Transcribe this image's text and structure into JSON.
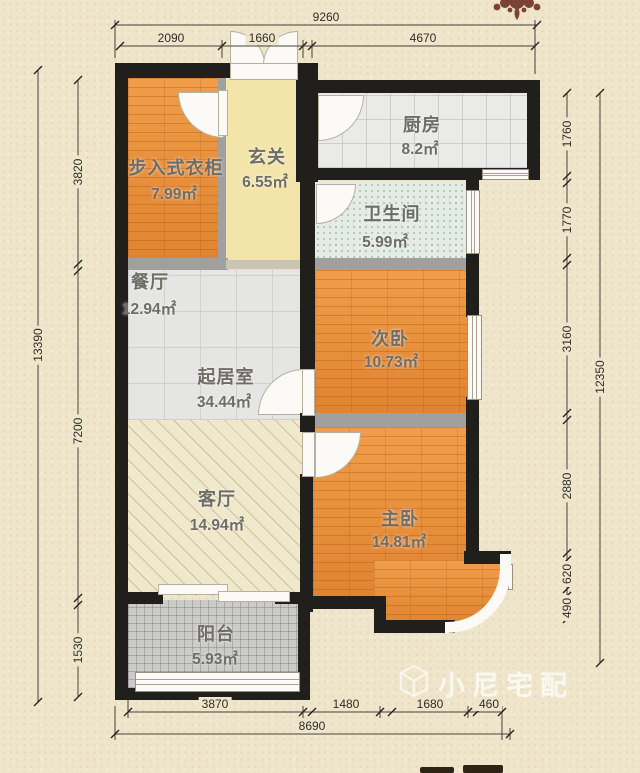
{
  "rooms": {
    "closet": {
      "name": "步入式衣柜",
      "area": "7.99㎡"
    },
    "entry": {
      "name": "玄关",
      "area": "6.55㎡"
    },
    "kitchen": {
      "name": "厨房",
      "area": "8.2㎡"
    },
    "bath": {
      "name": "卫生间",
      "area": "5.99㎡"
    },
    "dining": {
      "name": "餐厅",
      "area": "12.94㎡"
    },
    "living": {
      "name": "起居室",
      "area": "34.44㎡"
    },
    "bedroom2": {
      "name": "次卧",
      "area": "10.73㎡"
    },
    "parlor": {
      "name": "客厅",
      "area": "14.94㎡"
    },
    "master": {
      "name": "主卧",
      "area": "14.81㎡"
    },
    "balcony": {
      "name": "阳台",
      "area": "5.93㎡"
    }
  },
  "dimensions": {
    "top": {
      "total": "9260",
      "segments": [
        "2090",
        "1660",
        "4670"
      ]
    },
    "bottom": {
      "total": "8690",
      "segments": [
        "3870",
        "1480",
        "1680",
        "460"
      ]
    },
    "left": {
      "total": "13390",
      "segments": [
        "3820",
        "7200",
        "1530"
      ]
    },
    "right": {
      "total": "12350",
      "segments": [
        "1760",
        "1770",
        "3160",
        "2880",
        "620",
        "490"
      ]
    }
  },
  "watermark": {
    "text": "小尼宅配",
    "logo": "cube-icon"
  },
  "colors": {
    "wall": "#211f1c",
    "wood_floor": "#e78f3a",
    "entry_floor": "#f3e5aa",
    "kitchen_tile": "#eaeae8",
    "bath_tile": "#e4ece5",
    "parlor_floor": "#f0e8cb",
    "balcony_floor": "#cbcbc9",
    "background": "#eee5cb",
    "ornament": "#7b4334"
  }
}
